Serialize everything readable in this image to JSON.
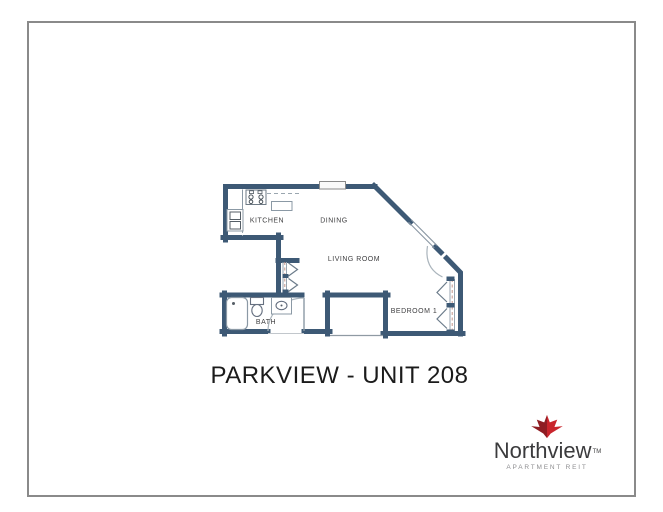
{
  "page": {
    "title": "PARKVIEW - UNIT 208"
  },
  "floorplan": {
    "rooms": [
      {
        "label": "KITCHEN"
      },
      {
        "label": "DINING"
      },
      {
        "label": "LIVING ROOM"
      },
      {
        "label": "BATH"
      },
      {
        "label": "BEDROOM 1"
      }
    ]
  },
  "logo": {
    "brand": "Northview",
    "trademark": "TM",
    "tagline": "APARTMENT REIT"
  },
  "colors": {
    "wall": "#3d5975",
    "fixture_line": "#8b99a5",
    "closet_dash": "#c4968c",
    "leaf_red": "#c9252c",
    "leaf_dark_red": "#8f1d23",
    "brand_text": "#3b3b3d",
    "tagline_text": "#8e8e90",
    "frame_border": "#8a8a8a",
    "title_text": "#1b1b1b"
  }
}
